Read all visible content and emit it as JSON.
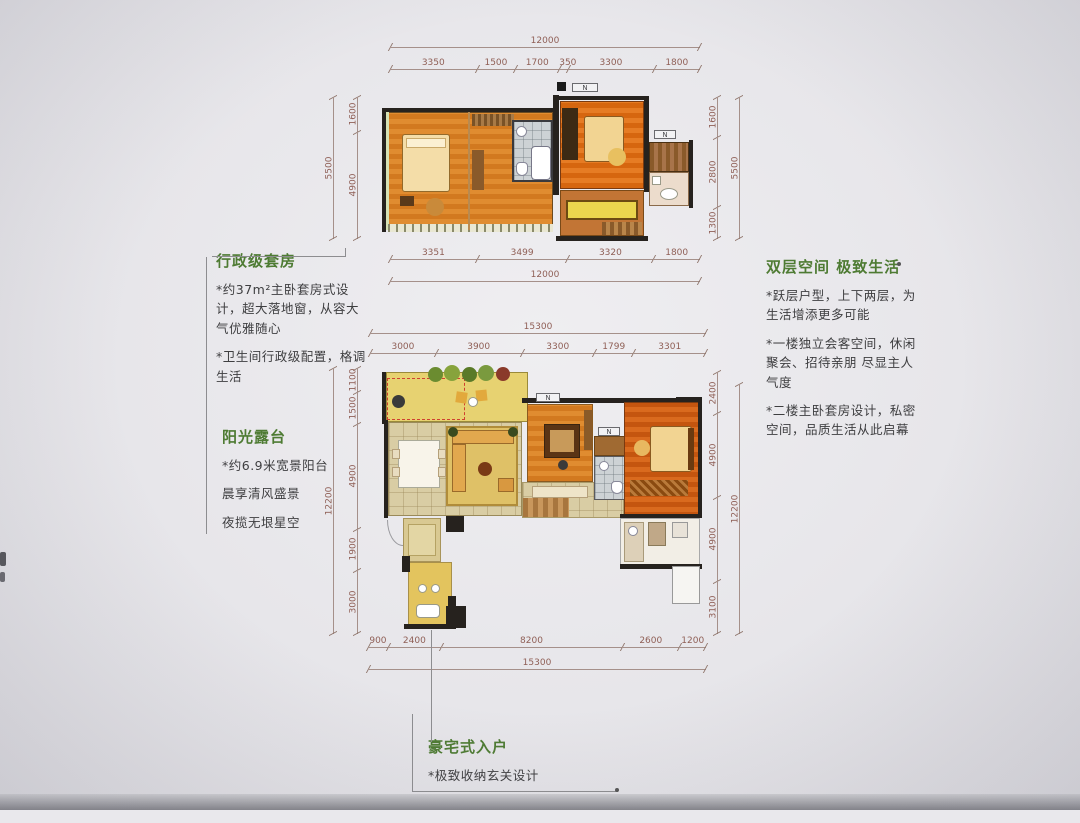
{
  "annotations": {
    "executive_suite": {
      "title": "行政级套房",
      "lines": [
        "*约37m²主卧套房式设计，超大落地窗，从容大气优雅随心",
        "*卫生间行政级配置，格调生活"
      ]
    },
    "sun_terrace": {
      "title": "阳光露台",
      "lines": [
        "*约6.9米宽景阳台",
        "晨享清风盛景",
        "夜揽无垠星空"
      ]
    },
    "double_space": {
      "title": "双层空间 极致生活",
      "lines": [
        "*跃层户型，上下两层，为生活增添更多可能",
        "*一楼独立会客空间，休闲聚会、招待亲朋 尽显主人气度",
        "*二楼主卧套房设计，私密空间，品质生活从此启幕"
      ]
    },
    "mansion_entry": {
      "title": "豪宅式入户",
      "lines": [
        "*极致收纳玄关设计",
        "尽享私密从容与尊崇"
      ]
    }
  },
  "upper_plan": {
    "top_total": [
      "12000"
    ],
    "top_segments": [
      "3350",
      "1500",
      "1700",
      "350",
      "3300",
      "1800"
    ],
    "bottom_segments": [
      "3351",
      "3499",
      "3320",
      "1800"
    ],
    "bottom_total": [
      "12000"
    ],
    "left_outer": [
      "5500"
    ],
    "left_segments": [
      "1600",
      "4900"
    ],
    "right_segments": [
      "1600",
      "2800",
      "1300"
    ],
    "right_outer": [
      "5500"
    ],
    "legend_label": "N"
  },
  "lower_plan": {
    "top_total": [
      "15300"
    ],
    "top_segments": [
      "3000",
      "3900",
      "3300",
      "1799",
      "3301"
    ],
    "bottom_segments": [
      "900",
      "2400",
      "8200",
      "2600",
      "1200"
    ],
    "bottom_total": [
      "15300"
    ],
    "left_outer": [
      "12200"
    ],
    "left_segments": [
      "1100",
      "1500",
      "4900",
      "1900",
      "3000"
    ],
    "right_segments": [
      "2400",
      "4900",
      "4900",
      "3100"
    ],
    "right_outer": [
      "12200"
    ],
    "marker_label": "N"
  },
  "colors": {
    "title_green": "#4e7b33",
    "dimension_text": "#8f5f56",
    "body_text": "#3e3e40",
    "wood_orange": "#e08c30",
    "deep_orange": "#d6660f",
    "terrace_yellow": "#e7d271",
    "tile_beige": "#d9cda4",
    "wall_black": "#26221e"
  }
}
